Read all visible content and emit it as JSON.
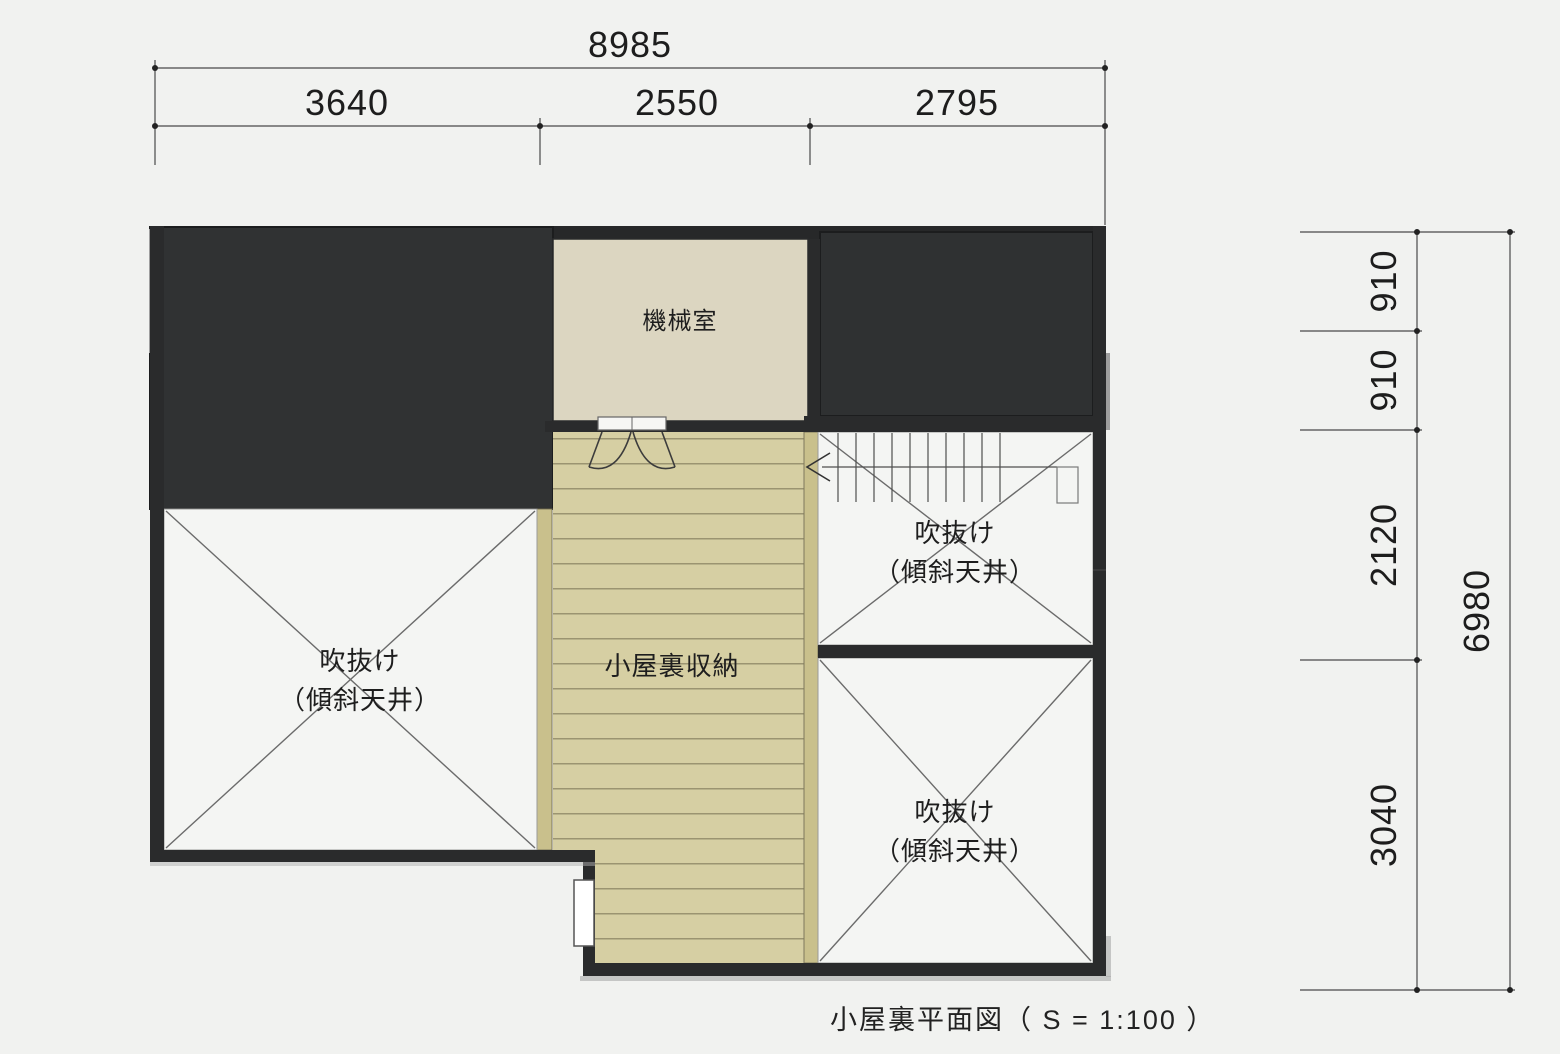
{
  "title": "小屋裏平面図",
  "caption": "小屋裏平面図（ S = 1:100 ）",
  "dimensions": {
    "top_total": "8985",
    "top_segments": [
      "3640",
      "2550",
      "2795"
    ],
    "right_segments": [
      "910",
      "910",
      "2120",
      "3040"
    ],
    "right_total": "6980"
  },
  "labels": {
    "machine_room": "機械室",
    "attic_storage": "小屋裏収納",
    "void": "吹抜け",
    "sloped_ceiling": "（傾斜天井）"
  },
  "colors": {
    "background": "#f1f2f0",
    "roof_dark": "#303233",
    "wall_dark": "#2a2b2c",
    "machine_room_fill": "#dcd6c1",
    "storage_fill": "#d6cfa3",
    "storage_stripe": "#9b9471",
    "storage_wall": "#c9c08c",
    "void_room_fill": "#f4f5f3",
    "x_brace_line": "#6b6b6b"
  }
}
